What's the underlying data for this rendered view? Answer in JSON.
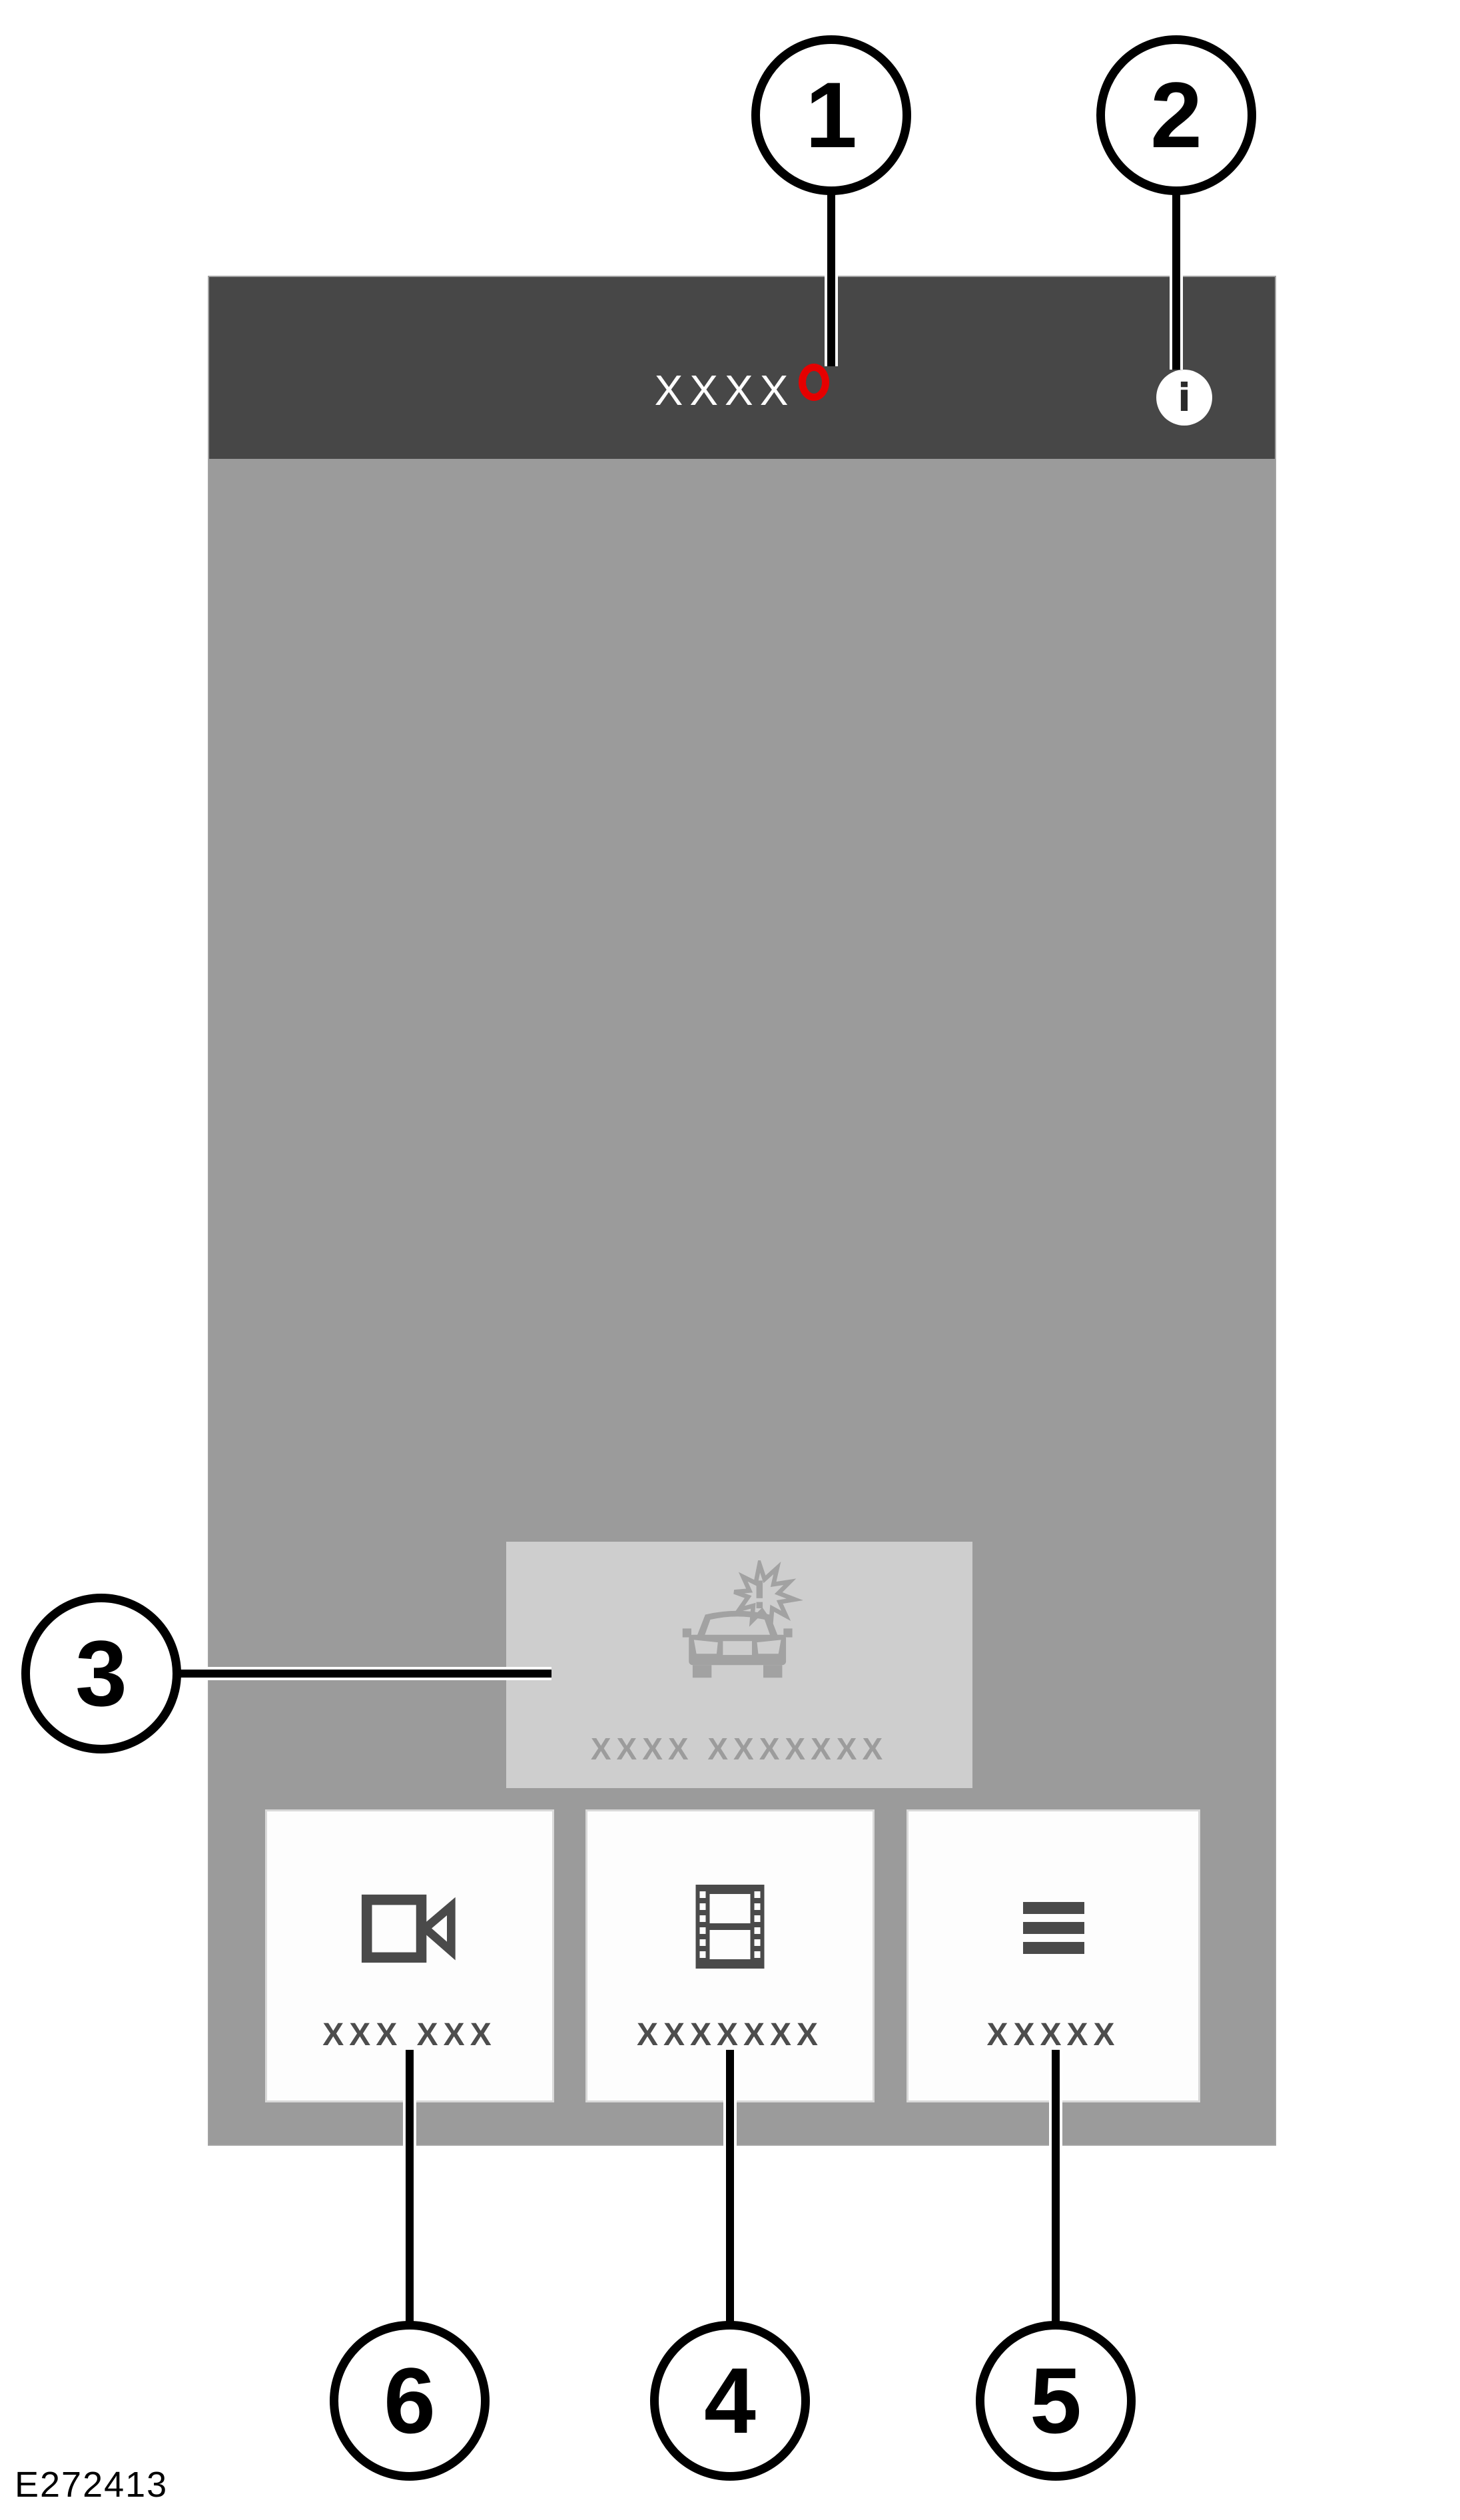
{
  "figure_code": "E272413",
  "callouts": [
    "1",
    "2",
    "3",
    "4",
    "5",
    "6"
  ],
  "app": {
    "header": {
      "title": "XXXX"
    },
    "info_glyph": "i",
    "event_button": {
      "label": "XXXX XXXXXXX",
      "icon": "car-collision-icon"
    },
    "bottom_buttons": [
      {
        "label": "XXX XXX",
        "icon": "video-camera-icon"
      },
      {
        "label": "XXXXXXX",
        "icon": "film-strip-icon"
      },
      {
        "label": "XXXXX",
        "icon": "menu-icon"
      }
    ]
  },
  "colors": {
    "header_bg": "#474747",
    "screen_bg": "#9b9b9b",
    "event_button_bg": "#cecece",
    "event_button_fg": "#9c9c9c",
    "record_indicator": "#e60000",
    "bottom_button_bg": "#fdfdfd",
    "bottom_button_fg": "#4d4d4d",
    "callout_stroke": "#000000"
  }
}
